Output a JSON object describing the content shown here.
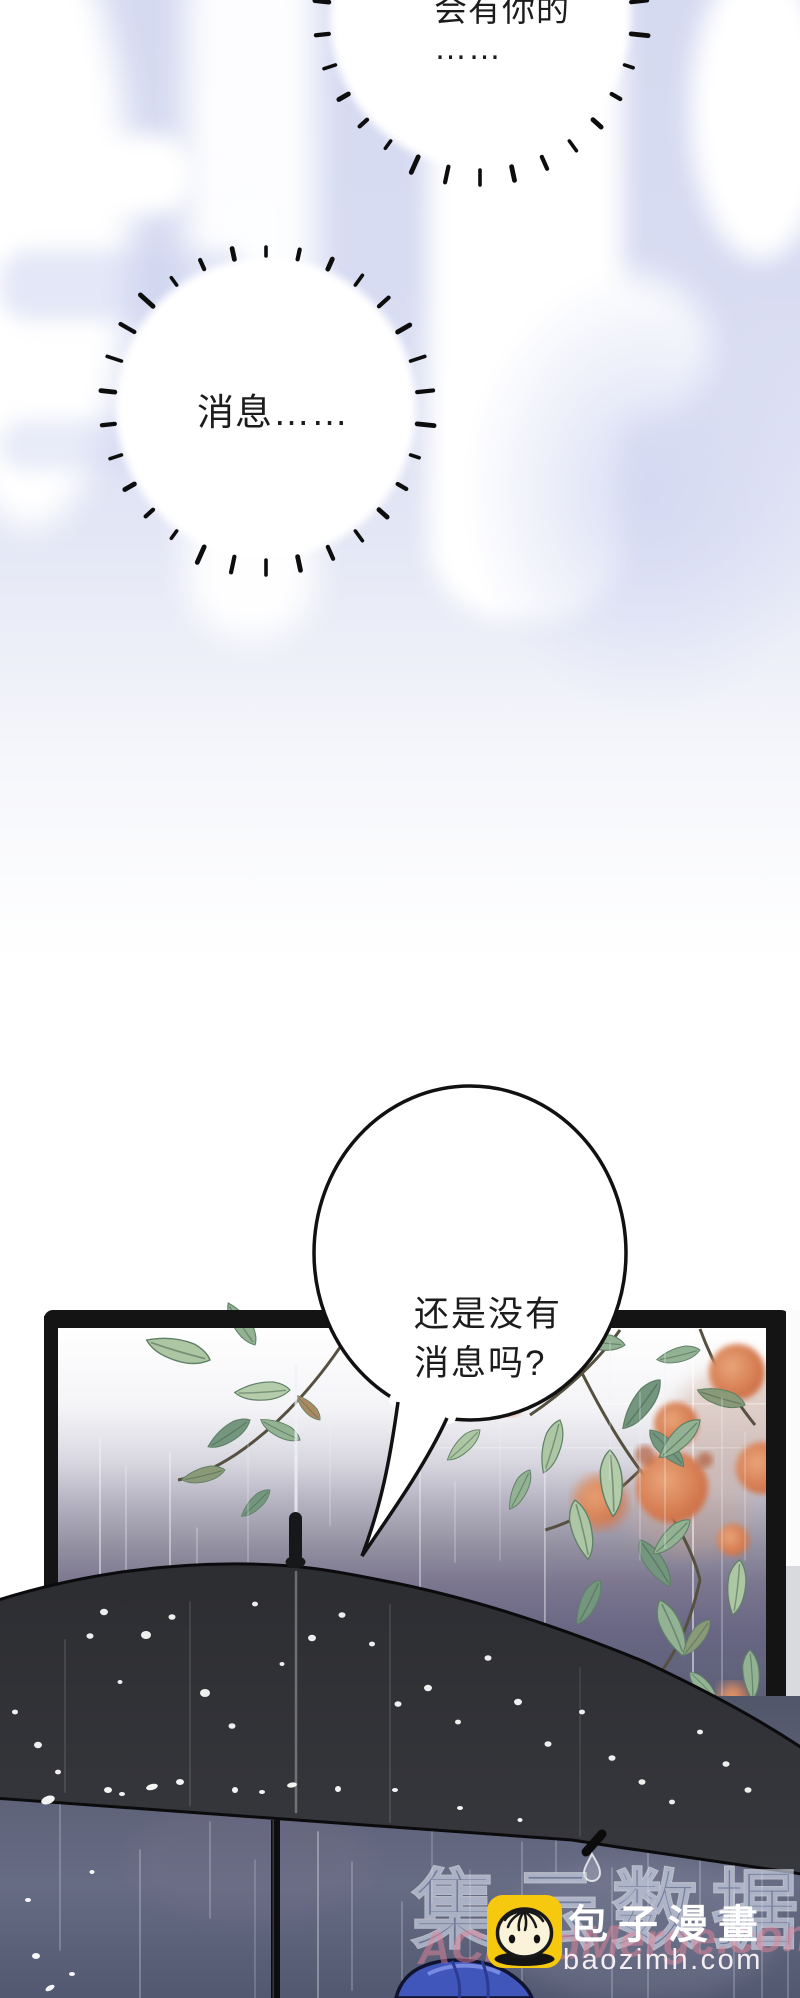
{
  "page": {
    "kind": "comic-page",
    "width": 800,
    "height": 1998
  },
  "bubbles": {
    "bubble1": {
      "line1": "会有你的",
      "ellipsis": "……"
    },
    "bubble2": {
      "text": "消息……"
    },
    "bubble3": {
      "line1": "还是没有",
      "line2": "消息吗?"
    }
  },
  "watermark": {
    "site_name": "包子漫畫",
    "site_domain": "baozimh.com",
    "faint_text": "集云数据",
    "script_text": "ACloudMerge.com",
    "logo_icon": "baozi-bun-icon",
    "logo_color": "#f6c80e"
  },
  "colors": {
    "sky_lavender": "#d7dbf2",
    "bubble_outline": "#111111",
    "window_frame": "#141414",
    "umbrella": "#313237",
    "leaf_green": "#a3bf9d",
    "leaf_dark": "#74967e",
    "persimmon_orange": "#d4805a",
    "rain_background": "#5d6078",
    "hair_blue": "#4156bb",
    "watermark_pink": "#e284a0",
    "watermark_blue": "#8c9bc3"
  }
}
